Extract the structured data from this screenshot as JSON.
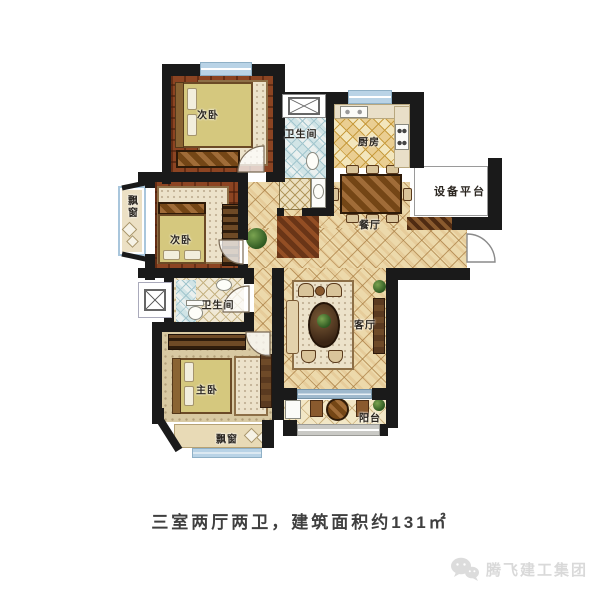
{
  "plan": {
    "rooms": {
      "bedroom_top": {
        "label": "次卧"
      },
      "bedroom_mid": {
        "label": "次卧"
      },
      "master": {
        "label": "主卧"
      },
      "bath_top": {
        "label": "卫生间"
      },
      "bath_mid": {
        "label": "卫生间"
      },
      "kitchen": {
        "label": "厨房"
      },
      "dining": {
        "label": "餐厅"
      },
      "living": {
        "label": "客厅"
      },
      "balcony": {
        "label": "阳台"
      },
      "equipment": {
        "label": "设备平台"
      },
      "bay_left": {
        "label": "飘窗"
      },
      "bay_bottom": {
        "label": "飘窗"
      }
    },
    "caption": "三室两厅两卫，建筑面积约131㎡",
    "watermark": {
      "brand": "腾飞建工集团",
      "icon": "wechat-bubbles-icon"
    },
    "colors": {
      "wall": "#1a1a1a",
      "window": "#b9d3e6",
      "tile": "#ecd9ab",
      "wood": "#7c3a1d",
      "label": "#2b2620",
      "caption": "#3f3f3f",
      "watermark": "#d9d9d9"
    }
  }
}
